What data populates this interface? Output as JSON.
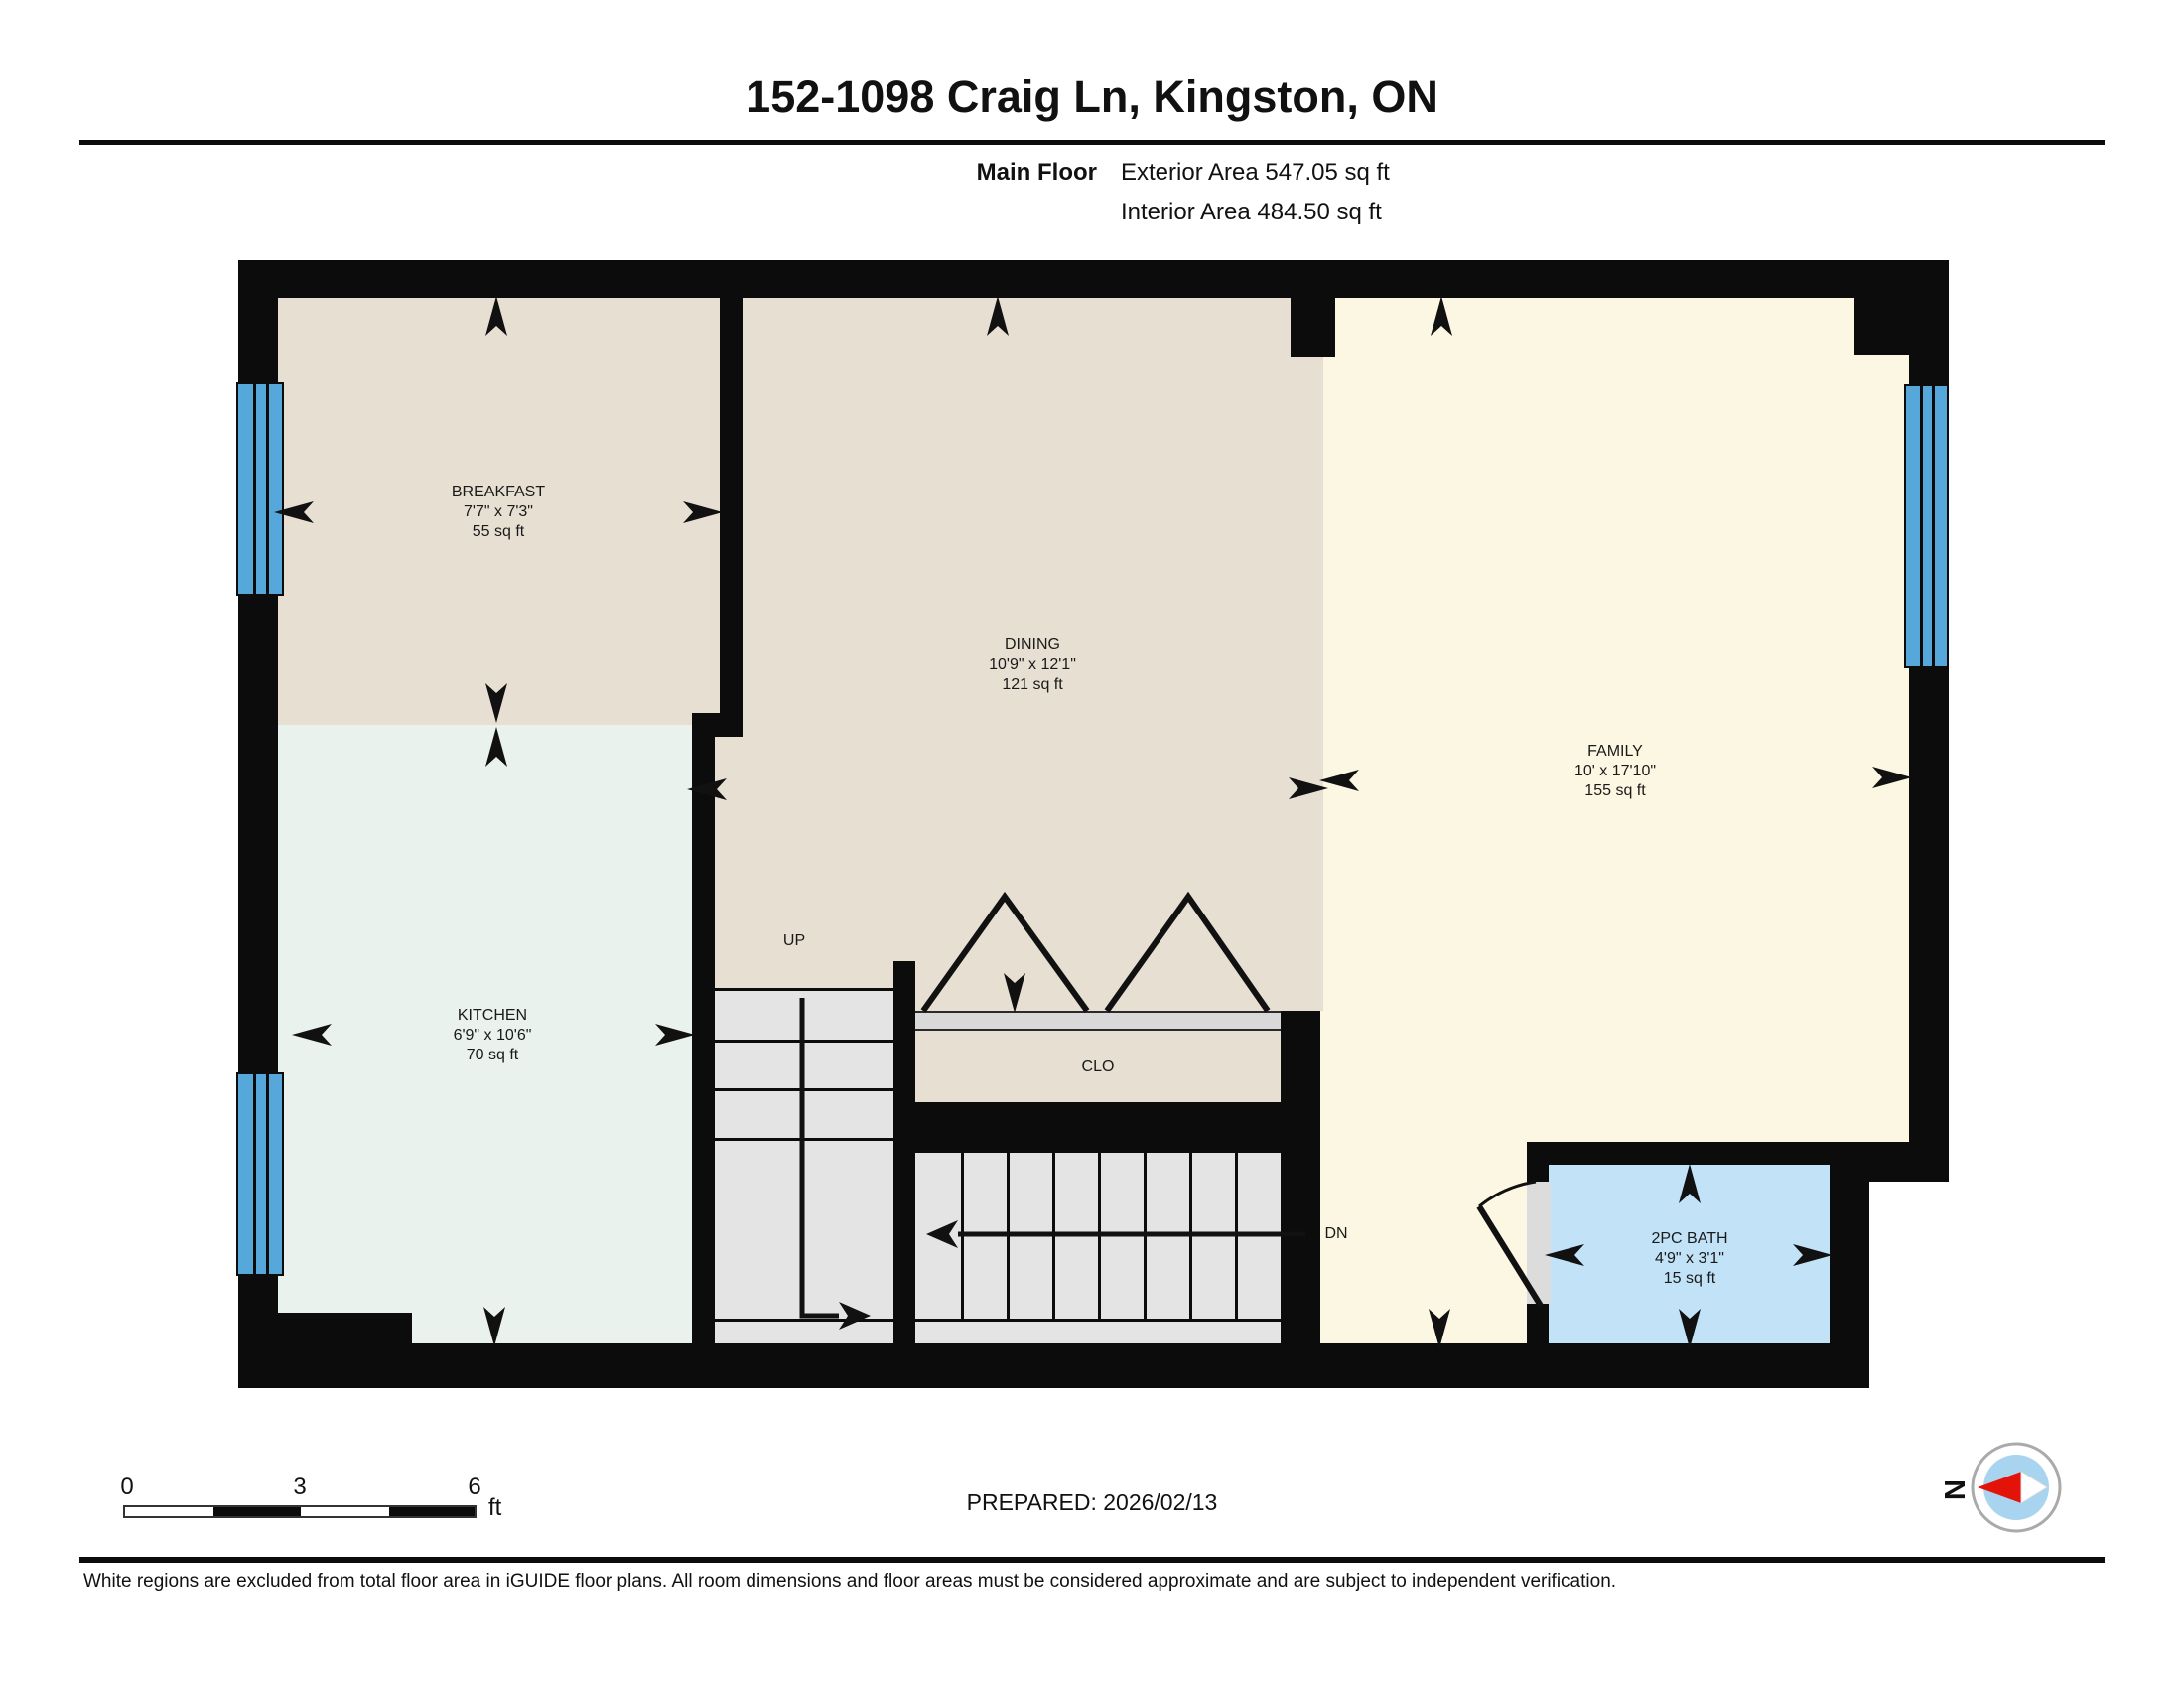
{
  "header": {
    "title": "152-1098 Craig Ln, Kingston, ON",
    "floor_label": "Main Floor",
    "exterior_area": "Exterior Area 547.05 sq ft",
    "interior_area": "Interior Area 484.50 sq ft"
  },
  "rooms": {
    "breakfast": {
      "name": "BREAKFAST",
      "dims": "7'7\" x 7'3\"",
      "area": "55 sq ft"
    },
    "dining": {
      "name": "DINING",
      "dims": "10'9\" x 12'1\"",
      "area": "121 sq ft"
    },
    "family": {
      "name": "FAMILY",
      "dims": "10' x 17'10\"",
      "area": "155 sq ft"
    },
    "kitchen": {
      "name": "KITCHEN",
      "dims": "6'9\" x 10'6\"",
      "area": "70 sq ft"
    },
    "bath": {
      "name": "2PC BATH",
      "dims": "4'9\" x 3'1\"",
      "area": "15 sq ft"
    },
    "closet": {
      "name": "CLO"
    },
    "stairs_up": {
      "label": "UP"
    },
    "stairs_down": {
      "label": "DN"
    }
  },
  "scale_bar": {
    "tick0": "0",
    "tick1": "3",
    "tick2": "6",
    "unit": "ft"
  },
  "prepared": "PREPARED: 2026/02/13",
  "compass": {
    "label": "N"
  },
  "footer": "White regions are excluded from total floor area in iGUIDE floor plans. All room dimensions and floor areas must be considered approximate and are subject to independent verification.",
  "colors": {
    "wall": "#0c0c0c",
    "breakfast_dining": "#e7dfd2",
    "kitchen": "#e9f2ec",
    "family": "#fcf7e2",
    "bath": "#c2e2f8",
    "window": "#57a8da",
    "stairs": "#e4e4e4",
    "compass_needle": "#e41309",
    "compass_inner": "#a8d4f0"
  }
}
